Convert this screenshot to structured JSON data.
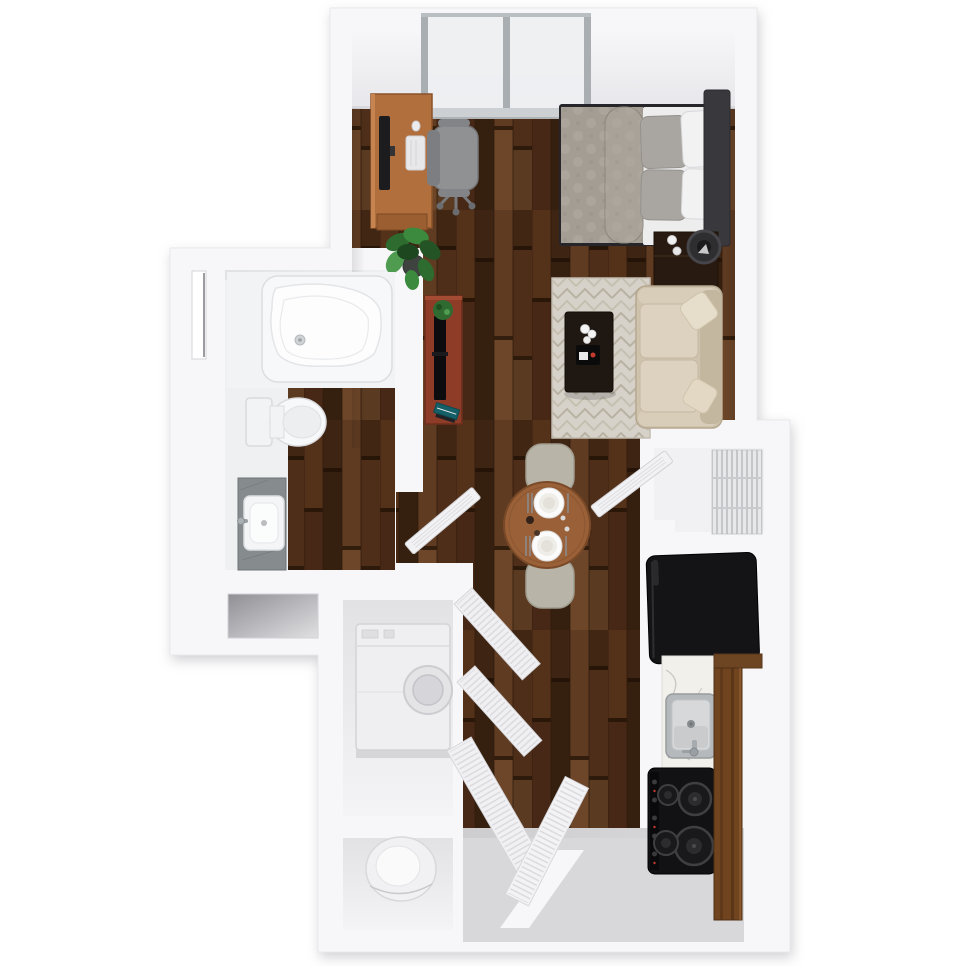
{
  "page": {
    "background": "#ffffff",
    "description": "3D top-down floor plan rendering of a studio apartment with sleeping area, living area, dining nook, bathroom, kitchen, entry closet and laundry utility closets"
  },
  "palette": {
    "wall": "#f7f7f9",
    "wall_shadow": "#e2e2e6",
    "wood_floor_dark": "#4b2c18",
    "wood_floor_light": "#6d4629",
    "entry_floor_gray": "#d8d8da",
    "rug_base": "#d6d2c9",
    "rug_chevron": "#b9b2a4",
    "sofa_beige": "#cfc3ae",
    "bed_duvet_gray": "#a39d94",
    "desk_wood": "#b06f3c",
    "tv_stand_wood": "#8e3c27",
    "dining_table_wood": "#9a6138",
    "cabinet_wood": "#6f441f",
    "appliance_black": "#141416",
    "fixture_white": "#f2f2f4",
    "stone_vanity_gray": "#868b8e",
    "plant_green": "#3c8a3e",
    "window_glass": "#edeff1",
    "accent_teal": "#156068",
    "accent_red": "#c23b2e"
  },
  "rooms": [
    {
      "id": "sleeping-area",
      "fixtures": [
        "window",
        "desk",
        "monitor",
        "keyboard",
        "mouse",
        "office-chair",
        "bed",
        "duvet",
        "pillows",
        "headboard",
        "nightstand",
        "table-lamp",
        "potted-plant"
      ]
    },
    {
      "id": "living-area",
      "fixtures": [
        "tv-stand",
        "television",
        "plant-pot",
        "books",
        "area-rug",
        "coffee-table",
        "sofa",
        "throw-pillows"
      ]
    },
    {
      "id": "dining-nook",
      "fixtures": [
        "round-dining-table",
        "place-settings",
        "dining-chairs"
      ]
    },
    {
      "id": "bathroom",
      "fixtures": [
        "bathtub",
        "toilet",
        "vanity-sink",
        "wall-niche",
        "window-slot",
        "bathroom-door"
      ]
    },
    {
      "id": "entry-closet",
      "fixtures": [
        "wire-shelving",
        "closet-door"
      ]
    },
    {
      "id": "kitchen",
      "fixtures": [
        "refrigerator",
        "countertop",
        "kitchen-sink",
        "faucet",
        "range-cooktop",
        "tall-cabinet"
      ]
    },
    {
      "id": "laundry-utility",
      "fixtures": [
        "washer-dryer",
        "water-heater",
        "louvered-bifold-doors"
      ]
    },
    {
      "id": "entry-vestibule",
      "fixtures": [
        "light-floor-patch"
      ]
    }
  ]
}
